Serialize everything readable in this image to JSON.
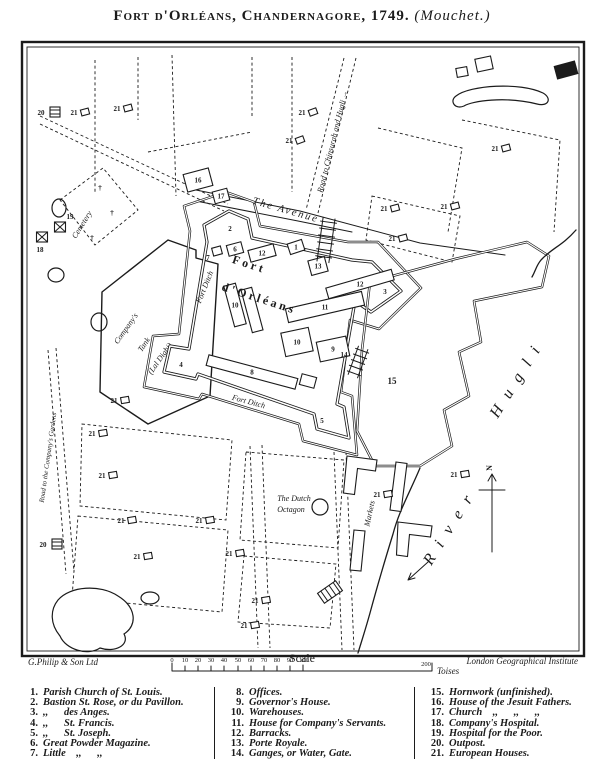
{
  "title": {
    "main": "Fort d'Orléans, Chandernagore, 1749.",
    "credit": "(Mouchet.)"
  },
  "map": {
    "labels": {
      "avenue": "The Avenue",
      "road_chinsurah": "Road to Chinsurah and Hugli →",
      "road_gardens": "Road to the Company's Gardens",
      "fort_name_1": "Fort",
      "fort_name_2": "d'Orléans",
      "fort_ditch": "Fort Ditch",
      "tank_1": "Company's",
      "tank_2": "Tank",
      "tank_3": "(Lal Dighi)",
      "cemetery": "Cemetery",
      "octagon_1": "The Dutch",
      "octagon_2": "Octagon",
      "markets": "Markets",
      "river_1": "River",
      "river_2": "Hugli",
      "north": "N"
    },
    "icons": {
      "grave_cross": "†"
    }
  },
  "scale": {
    "label": "Scale",
    "ticks": [
      "0",
      "10",
      "20",
      "30",
      "40",
      "50",
      "60",
      "70",
      "80",
      "90",
      "100"
    ],
    "far_tick": "200",
    "unit": "Toises"
  },
  "imprint": {
    "publisher": "G.Philip & Son Ltd",
    "institute": "London Geographical Institute"
  },
  "legend": {
    "col1": [
      {
        "n": "1",
        "label": "Parish Church of St. Louis."
      },
      {
        "n": "2",
        "label": "Bastion St. Rose, or du Pavillon."
      },
      {
        "n": "3",
        "label": ",,  des Anges."
      },
      {
        "n": "4",
        "label": ",,  St. Francis."
      },
      {
        "n": "5",
        "label": ",,  St. Joseph."
      },
      {
        "n": "6",
        "label": "Great Powder Magazine."
      },
      {
        "n": "7",
        "label": "Little ,,  ,,"
      }
    ],
    "col2": [
      {
        "n": "8",
        "label": "Offices."
      },
      {
        "n": "9",
        "label": "Governor's House."
      },
      {
        "n": "10",
        "label": "Warehouses."
      },
      {
        "n": "11",
        "label": "House for Company's Servants."
      },
      {
        "n": "12",
        "label": "Barracks."
      },
      {
        "n": "13",
        "label": "Porte Royale."
      },
      {
        "n": "14",
        "label": "Ganges, or Water, Gate."
      }
    ],
    "col3": [
      {
        "n": "15",
        "label": "Hornwork (unfinished)."
      },
      {
        "n": "16",
        "label": "House of the Jesuit Fathers."
      },
      {
        "n": "17",
        "label": "Church ,,  ,,  ,,"
      },
      {
        "n": "18",
        "label": "Company's Hospital."
      },
      {
        "n": "19",
        "label": "Hospital for the Poor."
      },
      {
        "n": "20",
        "label": "Outpost."
      },
      {
        "n": "21",
        "label": "European Houses."
      }
    ]
  }
}
